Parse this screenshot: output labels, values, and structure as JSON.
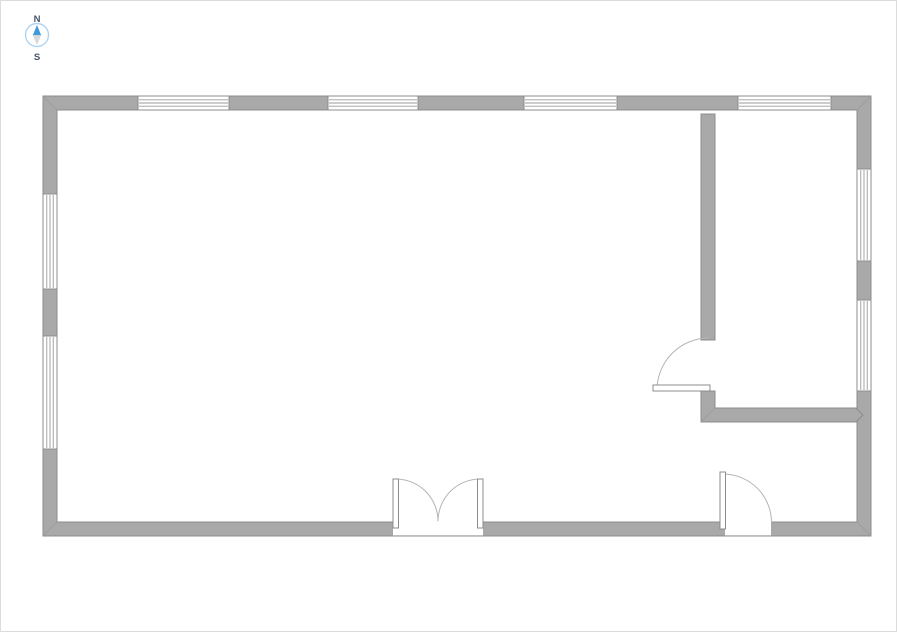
{
  "page": {
    "background": "#ffffff",
    "border_color": "#dcdcdc"
  },
  "compass": {
    "north_label": "N",
    "south_label": "S",
    "ring_color": "#aed4f2",
    "face_color": "#ffffff",
    "north_arrow_color": "#3d9bdc",
    "south_arrow_color": "#d9d9d9",
    "label_color": "#44546a"
  },
  "floor_plan": {
    "colors": {
      "wall_fill": "#a9a9a9",
      "wall_stroke": "#8c8c8c",
      "miter_line": "#9c9c9c",
      "window_fill": "#ffffff",
      "window_stroke": "#8c8c8c",
      "glazing_line": "#9a9a9a",
      "door_leaf_fill": "#ffffff",
      "door_leaf_stroke": "#8c8c8c",
      "swing_arc": "#b5b5b5",
      "opening_fill": "#ffffff"
    },
    "exterior": {
      "outer": {
        "x": 42,
        "y": 95,
        "w": 828,
        "h": 440
      },
      "thickness": 14
    },
    "windows": [
      {
        "wall": "top",
        "from": 137,
        "to": 228
      },
      {
        "wall": "top",
        "from": 327,
        "to": 417
      },
      {
        "wall": "top",
        "from": 523,
        "to": 616
      },
      {
        "wall": "top",
        "from": 737,
        "to": 830
      },
      {
        "wall": "left",
        "from": 193,
        "to": 288
      },
      {
        "wall": "left",
        "from": 335,
        "to": 448
      },
      {
        "wall": "right",
        "from": 168,
        "to": 260
      },
      {
        "wall": "right",
        "from": 299,
        "to": 390
      }
    ],
    "door_openings": [
      {
        "wall": "bottom",
        "from": 392,
        "to": 482
      },
      {
        "wall": "bottom",
        "from": 724,
        "to": 770
      }
    ],
    "interior_walls": [
      {
        "name": "partition-vertical",
        "points": [
          [
            700,
            113
          ],
          [
            714,
            113
          ],
          [
            714,
            339
          ],
          [
            700,
            339
          ]
        ]
      },
      {
        "name": "partition-lower-l",
        "points": [
          [
            700,
            390
          ],
          [
            714,
            390
          ],
          [
            714,
            407
          ],
          [
            855,
            407
          ],
          [
            862,
            414
          ],
          [
            855,
            421
          ],
          [
            700,
            421
          ]
        ]
      }
    ],
    "miter_lines": [
      [
        [
          42,
          95
        ],
        [
          56,
          109
        ]
      ],
      [
        [
          870,
          95
        ],
        [
          856,
          109
        ]
      ],
      [
        [
          870,
          535
        ],
        [
          856,
          521
        ]
      ],
      [
        [
          42,
          535
        ],
        [
          56,
          521
        ]
      ],
      [
        [
          700,
          421
        ],
        [
          714,
          407
        ]
      ]
    ],
    "door_leaves": [
      {
        "name": "double-door-left-leaf",
        "x": 392,
        "y": 478,
        "w": 5.5,
        "h": 49
      },
      {
        "name": "double-door-right-leaf",
        "x": 476.5,
        "y": 478,
        "w": 5.5,
        "h": 49
      },
      {
        "name": "single-door-leaf",
        "x": 719,
        "y": 471,
        "w": 5.5,
        "h": 57
      },
      {
        "name": "interior-door-leaf",
        "x": 652,
        "y": 384,
        "w": 57,
        "h": 6
      }
    ],
    "swing_arcs": [
      {
        "name": "double-door-left-swing",
        "d": "M 394.7 478 A 42.3 42.3 0 0 1 437 520.3"
      },
      {
        "name": "double-door-right-swing",
        "d": "M 479.3 478 A 42.3 42.3 0 0 0 437 520.3"
      },
      {
        "name": "single-door-swing",
        "d": "M 722 473 A 48.5 48.5 0 0 1 770.5 521.5"
      },
      {
        "name": "interior-door-swing",
        "d": "M 656 389 A 52 52 0 0 1 708 337"
      }
    ]
  }
}
